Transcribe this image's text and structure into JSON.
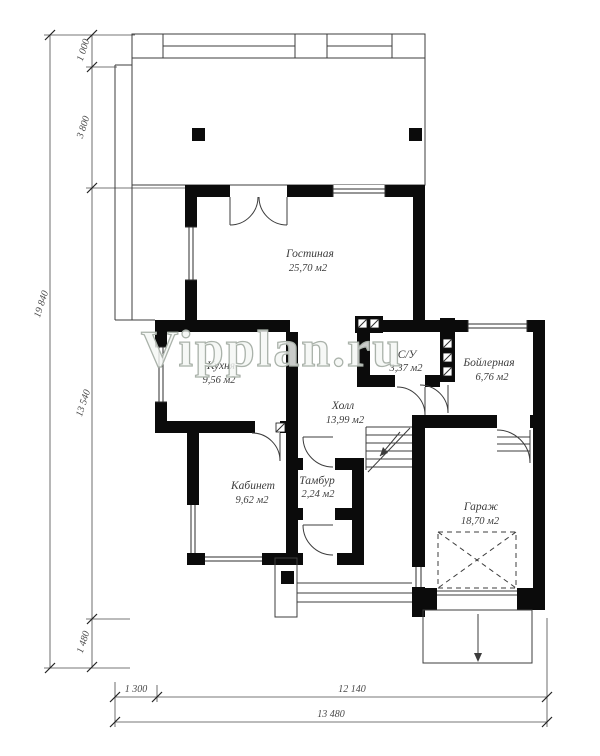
{
  "watermark": "Vipplan.ru",
  "rooms": {
    "living": {
      "name": "Гостиная",
      "area": "25,70 м2"
    },
    "kitchen": {
      "name": "Кухня",
      "area": "9,56 м2"
    },
    "wc": {
      "name": "С/У",
      "area": "3,37 м2"
    },
    "hall": {
      "name": "Холл",
      "area": "13,99 м2"
    },
    "boiler": {
      "name": "Бойлерная",
      "area": "6,76 м2"
    },
    "study": {
      "name": "Кабинет",
      "area": "9,62 м2"
    },
    "vestibule": {
      "name": "Тамбур",
      "area": "2,24 м2"
    },
    "garage": {
      "name": "Гараж",
      "area": "18,70 м2"
    }
  },
  "dimensions": {
    "total_height": "19 840",
    "seg_1000": "1 000",
    "seg_3800": "3 800",
    "seg_13540": "13 540",
    "seg_1480": "1 480",
    "seg_1300": "1 300",
    "seg_12140": "12 140",
    "total_width": "13 480"
  },
  "colors": {
    "wall": "#0b0b0b",
    "thin_line": "#3c3c3c",
    "dim_line": "#4a4a4a",
    "watermark_fill": "#f4f6f4"
  }
}
